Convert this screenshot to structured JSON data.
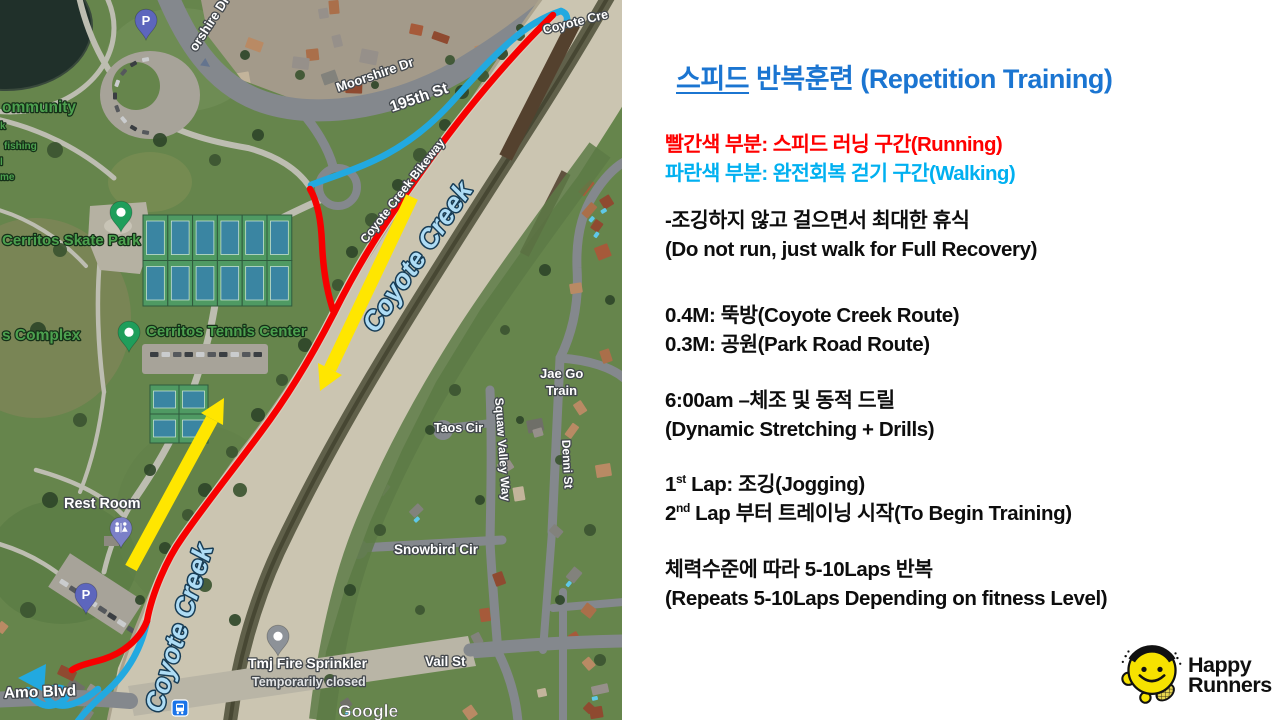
{
  "panel": {
    "title_underlined": "스피드",
    "title_rest": " 반복훈련 (Repetition Training)",
    "title_color": "#1b75d1",
    "legend_red": "빨간색 부분: 스피드 러닝 구간(Running)",
    "legend_cyan": "파란색 부분: 완전회복 걷기 구간(Walking)",
    "b1": [
      "-조깅하지 않고 걸으면서 최대한 휴식",
      "(Do not run, just walk for Full Recovery)"
    ],
    "b2": [
      "0.4M: 뚝방(Coyote Creek Route)",
      "0.3M: 공원(Park Road Route)"
    ],
    "b3": [
      "6:00am –체조 및 동적 드릴",
      "(Dynamic Stretching + Drills)"
    ],
    "b4": {
      "l1": {
        "pre": "1",
        "sup": "st",
        "post": " Lap: 조깅(Jogging)"
      },
      "l2": {
        "pre": "2",
        "sup": "nd",
        "post": " Lap 부터 트레이닝 시작(To Begin Training)"
      }
    },
    "b5": [
      "체력수준에 따라 5-10Laps 반복",
      "(Repeats 5-10Laps Depending on fitness Level)"
    ],
    "colors": {
      "running": "#ff0000",
      "walking": "#00b0f0"
    }
  },
  "logo": {
    "line1": "Happy",
    "line2": "Runners",
    "face_color": "#f6e200"
  },
  "map": {
    "streets": {
      "moorshire": "Moorshire Dr",
      "moorshire_top": "orshire Dr",
      "st195": "195th St",
      "coyote_rd": "Coyote Cre",
      "bikeway": "Coyote Creek Bikeway",
      "snowbird": "Snowbird Cir",
      "vail": "Vail St",
      "taos": "Taos Cir",
      "squaw": "Squaw Valley Way",
      "denni": "Denni St",
      "amo": "Amo Blvd"
    },
    "water": {
      "creek_mid": "Coyote Creek",
      "creek_bottom": "Coyote Creek"
    },
    "pois": {
      "skate_park": "Cerritos Skate Park",
      "tennis_center": "Cerritos Tennis Center",
      "rest_room": "Rest Room",
      "tmj": "Tmj Fire Sprinkler",
      "tmj_status": "Temporarily closed",
      "jae1": "Jae Go",
      "jae2": "Train",
      "community": "ommunity",
      "frag_k": "k",
      "fishing": "fishing",
      "frag_l": "l",
      "frag_me": "me",
      "complex": "s Complex",
      "parking": "P"
    },
    "watermark": "Google",
    "route_colors": {
      "running": "#ff0000",
      "walking": "#22a9e0",
      "direction_arrow": "#ffe600"
    }
  }
}
